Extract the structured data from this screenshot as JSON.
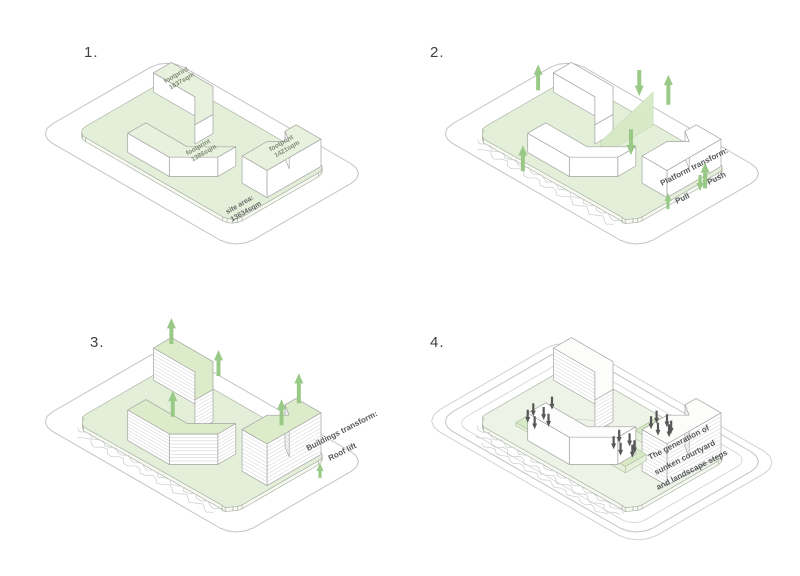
{
  "panels": [
    {
      "number": "1.",
      "labels": {
        "building_a": {
          "line1": "footprint",
          "line2": "1637sqm"
        },
        "building_b": {
          "line1": "footprint",
          "line2": "1386sqm"
        },
        "building_c": {
          "line1": "footprint",
          "line2": "1421sqm"
        },
        "site_area": {
          "line1": "site area:",
          "line2": "13634sqm"
        }
      }
    },
    {
      "number": "2.",
      "legend": {
        "title": "Platform transform:",
        "pull_label": "Pull",
        "push_label": "Push"
      }
    },
    {
      "number": "3.",
      "legend": {
        "title": "Buildings transform:",
        "lift_label": "Roof lift"
      }
    },
    {
      "number": "4.",
      "caption": {
        "line1": "The generation of",
        "line2": "sunken courtyard",
        "line3": "and landscape steps"
      }
    }
  ],
  "colors": {
    "platform_green": "#e4efda",
    "platform_green_pale": "#edf3e6",
    "building_top_green": "#e7f1dd",
    "roof_green": "#dcebc9",
    "plane_green": "#d8e9c6",
    "arrow_green": "#94c681",
    "dark_arrow": "#4f4f4f",
    "outline_gray": "#c3c3c3",
    "building_stroke": "#a3a3a3",
    "label_text": "#58595b",
    "footprint_text": "#7d8a74"
  }
}
